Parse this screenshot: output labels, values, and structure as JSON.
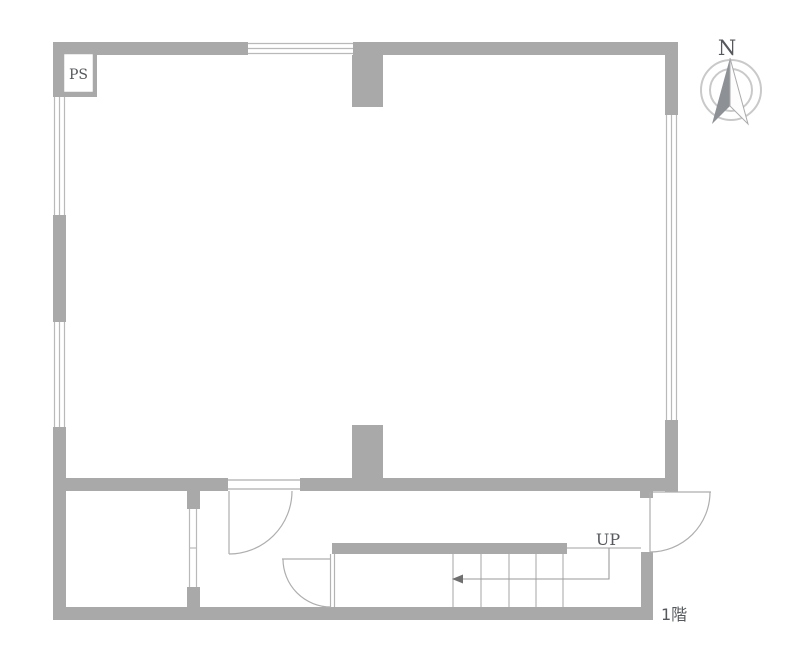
{
  "floor_plan": {
    "labels": {
      "pipe_shaft": "PS",
      "compass_north": "N",
      "stairs_direction": "UP",
      "floor": "1階"
    },
    "colors": {
      "background": "#ffffff",
      "wall": "#a9a9a9",
      "window_line": "#b9b9b9",
      "door_swing_line": "#aeaeae",
      "text": "#55585c",
      "compass_ring": "#c9c9c9",
      "compass_needle_dark": "#8d9196",
      "compass_needle_light": "#fdfdfd"
    },
    "stairs": {
      "tread_count": 5,
      "direction_label": "UP"
    },
    "compass": {
      "direction": "N"
    }
  }
}
